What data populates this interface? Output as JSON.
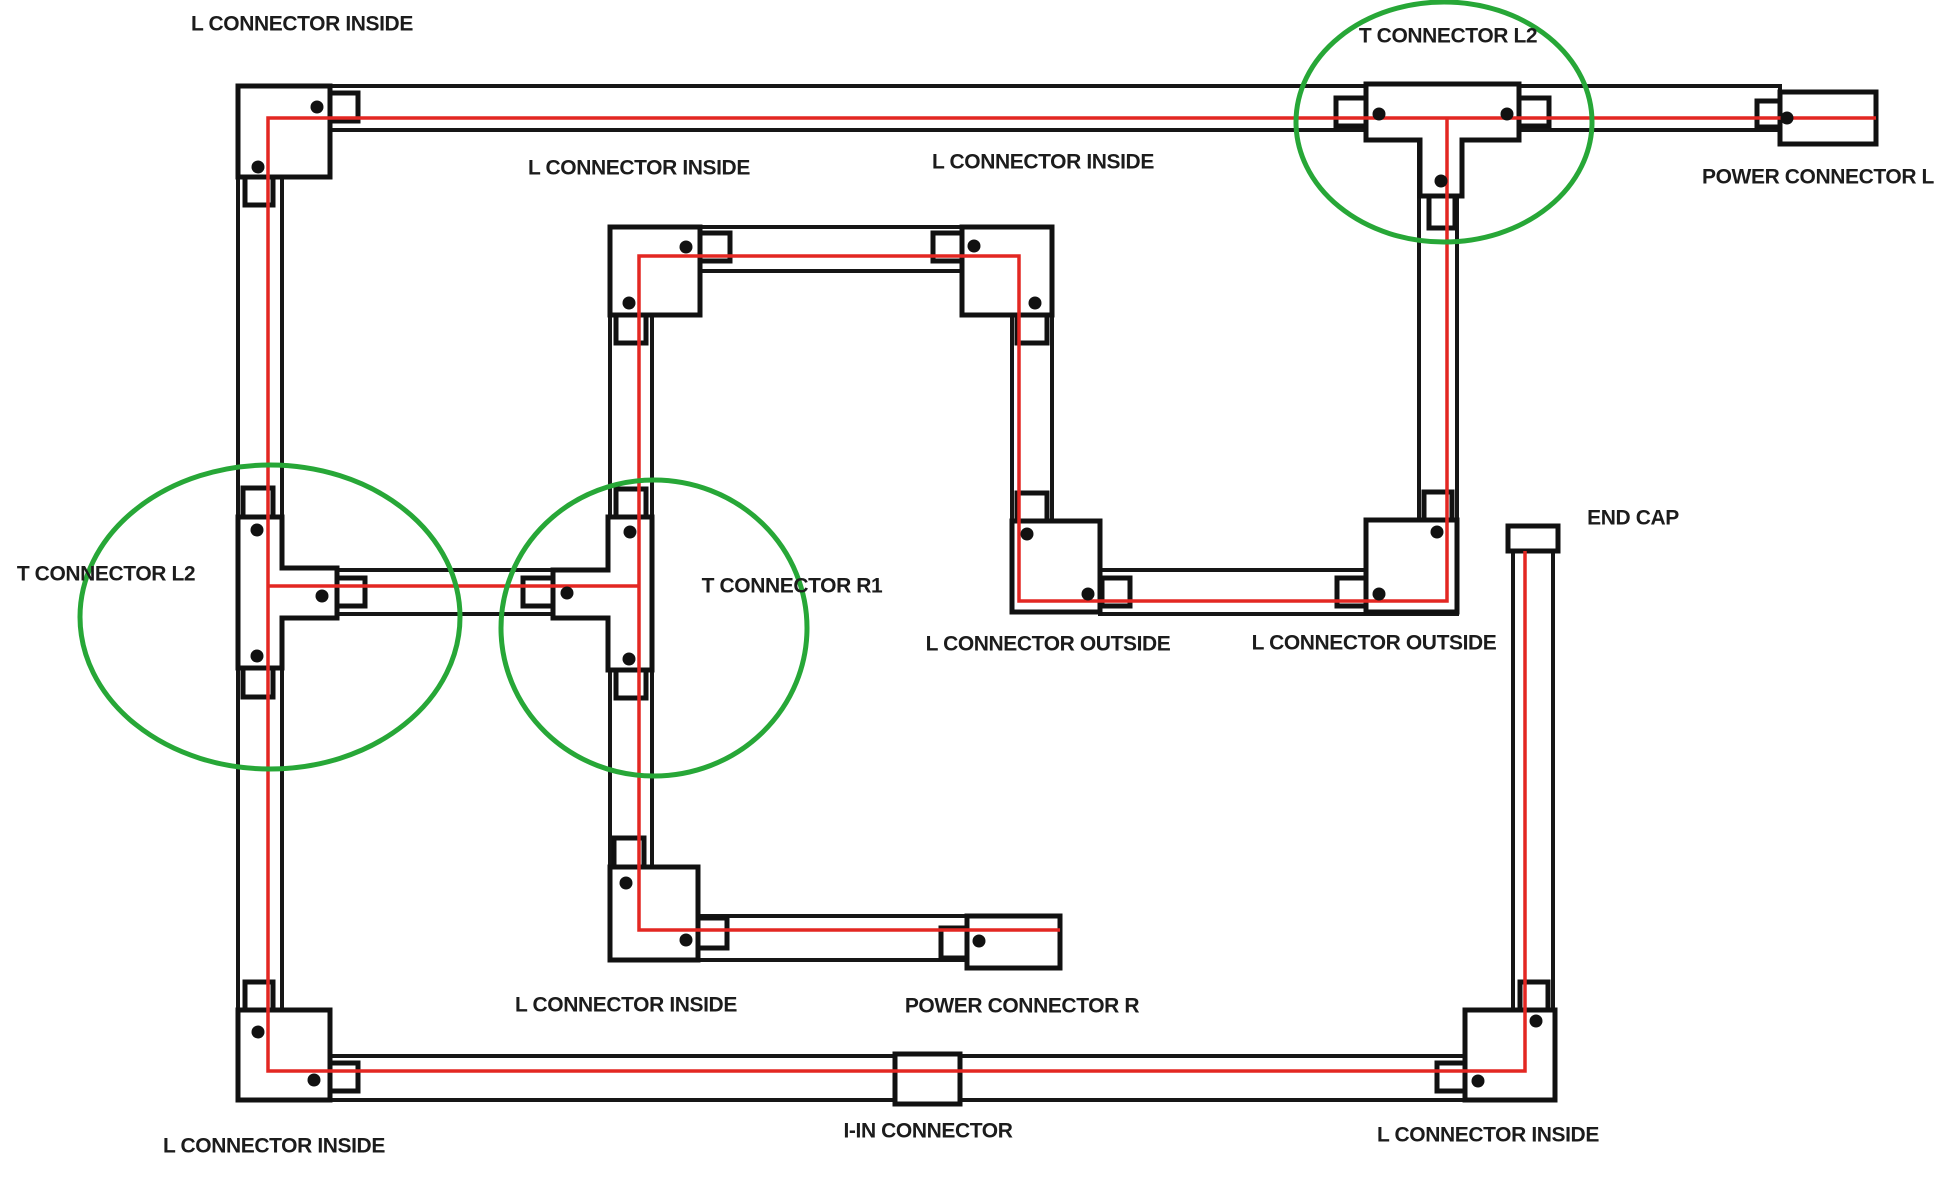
{
  "diagram": {
    "title": "Track lighting connector layout diagram",
    "canvas": {
      "width": 1943,
      "height": 1192,
      "background": "#ffffff"
    },
    "style": {
      "track_stroke": "#161616",
      "piece_stroke": "#111111",
      "wire_color": "#e32722",
      "highlight_color": "#27a737",
      "dot_color": "#111111",
      "dot_radius": 6.5,
      "label_color": "#1c1c1c",
      "label_font_size": 21
    },
    "labels": [
      {
        "id": "label-l-connector-inside-top-left",
        "text": "L CONNECTOR INSIDE",
        "x": 302,
        "y": 24
      },
      {
        "id": "label-t-connector-l2-top",
        "text": "T CONNECTOR L2",
        "x": 1448,
        "y": 36
      },
      {
        "id": "label-l-connector-inside-inner-top-left",
        "text": "L CONNECTOR INSIDE",
        "x": 639,
        "y": 168
      },
      {
        "id": "label-l-connector-inside-inner-top-right",
        "text": "L CONNECTOR INSIDE",
        "x": 1043,
        "y": 162
      },
      {
        "id": "label-power-connector-l",
        "text": "POWER CONNECTOR L",
        "x": 1818,
        "y": 177
      },
      {
        "id": "label-end-cap",
        "text": "END CAP",
        "x": 1633,
        "y": 518
      },
      {
        "id": "label-t-connector-l2-left",
        "text": "T CONNECTOR L2",
        "x": 106,
        "y": 574
      },
      {
        "id": "label-t-connector-r1",
        "text": "T CONNECTOR R1",
        "x": 792,
        "y": 586
      },
      {
        "id": "label-l-connector-outside-left",
        "text": "L CONNECTOR OUTSIDE",
        "x": 1048,
        "y": 644
      },
      {
        "id": "label-l-connector-outside-right",
        "text": "L CONNECTOR OUTSIDE",
        "x": 1374,
        "y": 643
      },
      {
        "id": "label-l-connector-inside-inner-bottom",
        "text": "L CONNECTOR INSIDE",
        "x": 626,
        "y": 1005
      },
      {
        "id": "label-power-connector-r",
        "text": "POWER CONNECTOR R",
        "x": 1022,
        "y": 1006
      },
      {
        "id": "label-l-connector-inside-bottom-left",
        "text": "L CONNECTOR INSIDE",
        "x": 274,
        "y": 1146
      },
      {
        "id": "label-i-in-connector",
        "text": "I-IN CONNECTOR",
        "x": 928,
        "y": 1131
      },
      {
        "id": "label-l-connector-inside-bottom-right",
        "text": "L CONNECTOR INSIDE",
        "x": 1488,
        "y": 1135
      }
    ],
    "tracks": [
      {
        "id": "track-top",
        "x": 330,
        "y": 86,
        "w": 1450,
        "h": 44
      },
      {
        "id": "track-left",
        "x": 238,
        "y": 86,
        "w": 44,
        "h": 1014
      },
      {
        "id": "track-bottom",
        "x": 238,
        "y": 1056,
        "w": 1317,
        "h": 44
      },
      {
        "id": "track-endcap-vertical",
        "x": 1513,
        "y": 551,
        "w": 40,
        "h": 549
      },
      {
        "id": "track-inner-top",
        "x": 610,
        "y": 227,
        "w": 442,
        "h": 44
      },
      {
        "id": "track-inner-left",
        "x": 610,
        "y": 227,
        "w": 42,
        "h": 733
      },
      {
        "id": "track-inner-right-drop",
        "x": 1012,
        "y": 271,
        "w": 40,
        "h": 341
      },
      {
        "id": "track-inner-bottom",
        "x": 610,
        "y": 916,
        "w": 450,
        "h": 44
      },
      {
        "id": "track-branch-row",
        "x": 282,
        "y": 570,
        "w": 328,
        "h": 44
      },
      {
        "id": "track-outside-row",
        "x": 1100,
        "y": 570,
        "w": 357,
        "h": 44
      },
      {
        "id": "track-tee-top-drop",
        "x": 1419,
        "y": 140,
        "w": 38,
        "h": 472
      }
    ],
    "connector_pieces": {
      "corners": [
        {
          "id": "corner-l-inside-top-left",
          "x": 238,
          "y": 86,
          "w": 92,
          "h": 91
        },
        {
          "id": "corner-l-inside-inner-top-left",
          "x": 610,
          "y": 227,
          "w": 90,
          "h": 88
        },
        {
          "id": "corner-l-inside-inner-top-right",
          "x": 962,
          "y": 227,
          "w": 90,
          "h": 88
        },
        {
          "id": "corner-l-outside-left",
          "x": 1012,
          "y": 521,
          "w": 88,
          "h": 91
        },
        {
          "id": "corner-l-outside-right",
          "x": 1366,
          "y": 520,
          "w": 91,
          "h": 92
        },
        {
          "id": "corner-l-inside-inner-bottom",
          "x": 610,
          "y": 867,
          "w": 88,
          "h": 93
        },
        {
          "id": "corner-l-inside-bottom-right",
          "x": 1465,
          "y": 1010,
          "w": 90,
          "h": 90
        },
        {
          "id": "corner-l-inside-bottom-left",
          "x": 238,
          "y": 1010,
          "w": 92,
          "h": 90
        }
      ],
      "tees": [
        {
          "id": "tee-connector-l2-top",
          "points": "1366,84 1519,84 1519,140 1462,140 1462,196 1420,196 1420,140 1366,140"
        },
        {
          "id": "tee-connector-l2-left",
          "points": "238,517 282,517 282,568 337,568 337,618 282,618 282,668 238,668"
        },
        {
          "id": "tee-connector-r1",
          "points": "608,517 652,517 652,670 608,670 608,618 553,618 553,570 608,570"
        }
      ],
      "power_feeds": [
        {
          "id": "power-connector-l-box",
          "x": 1780,
          "y": 92,
          "w": 96,
          "h": 52
        },
        {
          "id": "power-connector-r-box",
          "x": 967,
          "y": 916,
          "w": 93,
          "h": 52
        }
      ],
      "end_cap": {
        "id": "end-cap-piece",
        "x": 1508,
        "y": 526,
        "w": 50,
        "h": 25
      },
      "inline_connector": {
        "id": "i-in-connector-box",
        "x": 895,
        "y": 1054,
        "w": 65,
        "h": 50
      },
      "tabs": [
        {
          "id": "tab-c1-right",
          "x": 330,
          "y": 93,
          "w": 28,
          "h": 28
        },
        {
          "id": "tab-c1-bottom",
          "x": 245,
          "y": 177,
          "w": 28,
          "h": 28
        },
        {
          "id": "tab-c2-right",
          "x": 700,
          "y": 233,
          "w": 30,
          "h": 28
        },
        {
          "id": "tab-c2-bottom",
          "x": 616,
          "y": 315,
          "w": 30,
          "h": 28
        },
        {
          "id": "tab-c3-left",
          "x": 933,
          "y": 233,
          "w": 29,
          "h": 28
        },
        {
          "id": "tab-c3-bottom",
          "x": 1017,
          "y": 315,
          "w": 30,
          "h": 28
        },
        {
          "id": "tab-tee-top-left",
          "x": 1336,
          "y": 98,
          "w": 30,
          "h": 28
        },
        {
          "id": "tab-tee-top-right",
          "x": 1519,
          "y": 98,
          "w": 30,
          "h": 28
        },
        {
          "id": "tab-tee-top-stem",
          "x": 1429,
          "y": 196,
          "w": 26,
          "h": 32
        },
        {
          "id": "tab-power-l",
          "x": 1757,
          "y": 101,
          "w": 23,
          "h": 26
        },
        {
          "id": "tab-t2-top",
          "x": 243,
          "y": 488,
          "w": 30,
          "h": 29
        },
        {
          "id": "tab-t2-bottom",
          "x": 243,
          "y": 668,
          "w": 30,
          "h": 29
        },
        {
          "id": "tab-t2-branch",
          "x": 337,
          "y": 578,
          "w": 28,
          "h": 28
        },
        {
          "id": "tab-t3-branch",
          "x": 523,
          "y": 578,
          "w": 30,
          "h": 28
        },
        {
          "id": "tab-t3-top",
          "x": 616,
          "y": 489,
          "w": 30,
          "h": 28
        },
        {
          "id": "tab-t3-bottom",
          "x": 616,
          "y": 670,
          "w": 30,
          "h": 28
        },
        {
          "id": "tab-c4-top",
          "x": 1017,
          "y": 493,
          "w": 30,
          "h": 28
        },
        {
          "id": "tab-c4-right",
          "x": 1102,
          "y": 578,
          "w": 28,
          "h": 28
        },
        {
          "id": "tab-c5-top",
          "x": 1424,
          "y": 492,
          "w": 28,
          "h": 28
        },
        {
          "id": "tab-c5-left",
          "x": 1337,
          "y": 578,
          "w": 29,
          "h": 28
        },
        {
          "id": "tab-c6-top",
          "x": 614,
          "y": 838,
          "w": 30,
          "h": 29
        },
        {
          "id": "tab-c6-right",
          "x": 698,
          "y": 918,
          "w": 29,
          "h": 30
        },
        {
          "id": "tab-power-r",
          "x": 941,
          "y": 928,
          "w": 26,
          "h": 30
        },
        {
          "id": "tab-c8-top",
          "x": 245,
          "y": 982,
          "w": 28,
          "h": 28
        },
        {
          "id": "tab-c8-right",
          "x": 330,
          "y": 1063,
          "w": 28,
          "h": 28
        },
        {
          "id": "tab-c7-left",
          "x": 1437,
          "y": 1063,
          "w": 28,
          "h": 28
        },
        {
          "id": "tab-c7-top",
          "x": 1520,
          "y": 982,
          "w": 28,
          "h": 28
        }
      ]
    },
    "dots": [
      {
        "id": "dot-corner-top-left-a",
        "x": 317,
        "y": 107
      },
      {
        "id": "dot-corner-top-left-b",
        "x": 258,
        "y": 167
      },
      {
        "id": "dot-corner-inner-tl-a",
        "x": 686,
        "y": 247
      },
      {
        "id": "dot-corner-inner-tl-b",
        "x": 629,
        "y": 303
      },
      {
        "id": "dot-corner-inner-tr-a",
        "x": 974,
        "y": 246
      },
      {
        "id": "dot-corner-inner-tr-b",
        "x": 1035,
        "y": 303
      },
      {
        "id": "dot-corner-outside-left-a",
        "x": 1027,
        "y": 534
      },
      {
        "id": "dot-corner-outside-left-b",
        "x": 1088,
        "y": 594
      },
      {
        "id": "dot-corner-outside-right-a",
        "x": 1437,
        "y": 532
      },
      {
        "id": "dot-corner-outside-right-b",
        "x": 1379,
        "y": 594
      },
      {
        "id": "dot-corner-inner-bl-a",
        "x": 626,
        "y": 883
      },
      {
        "id": "dot-corner-inner-bl-b",
        "x": 686,
        "y": 940
      },
      {
        "id": "dot-corner-bottom-right-a",
        "x": 1536,
        "y": 1021
      },
      {
        "id": "dot-corner-bottom-right-b",
        "x": 1478,
        "y": 1081
      },
      {
        "id": "dot-corner-bottom-left-a",
        "x": 258,
        "y": 1032
      },
      {
        "id": "dot-corner-bottom-left-b",
        "x": 314,
        "y": 1080
      },
      {
        "id": "dot-tee-top-a",
        "x": 1379,
        "y": 114
      },
      {
        "id": "dot-tee-top-b",
        "x": 1507,
        "y": 114
      },
      {
        "id": "dot-tee-top-stem",
        "x": 1441,
        "y": 181
      },
      {
        "id": "dot-tee-left-a",
        "x": 257,
        "y": 530
      },
      {
        "id": "dot-tee-left-b",
        "x": 257,
        "y": 656
      },
      {
        "id": "dot-tee-left-branch",
        "x": 322,
        "y": 596
      },
      {
        "id": "dot-tee-mid-a",
        "x": 630,
        "y": 532
      },
      {
        "id": "dot-tee-mid-b",
        "x": 629,
        "y": 659
      },
      {
        "id": "dot-tee-mid-branch",
        "x": 567,
        "y": 593
      },
      {
        "id": "dot-power-l",
        "x": 1787,
        "y": 118
      },
      {
        "id": "dot-power-r",
        "x": 979,
        "y": 941
      }
    ],
    "wire_paths": [
      {
        "id": "wire-main-loop",
        "points": "1876,118 268,118 268,1071 1525,1071 1525,551"
      },
      {
        "id": "wire-inner-run",
        "points": "1447,118 1447,601 1019,601 1019,256 639,256 639,930 1060,930"
      },
      {
        "id": "wire-tee-branch",
        "points": "639,586 268,586"
      }
    ],
    "highlight_ellipses": [
      {
        "id": "highlight-tee-connector-l2-left",
        "cx": 270,
        "cy": 617,
        "rx": 190,
        "ry": 152
      },
      {
        "id": "highlight-tee-connector-r1",
        "cx": 654,
        "cy": 628,
        "rx": 153,
        "ry": 148
      },
      {
        "id": "highlight-tee-connector-l2-top",
        "cx": 1444,
        "cy": 122,
        "rx": 148,
        "ry": 120
      }
    ]
  }
}
